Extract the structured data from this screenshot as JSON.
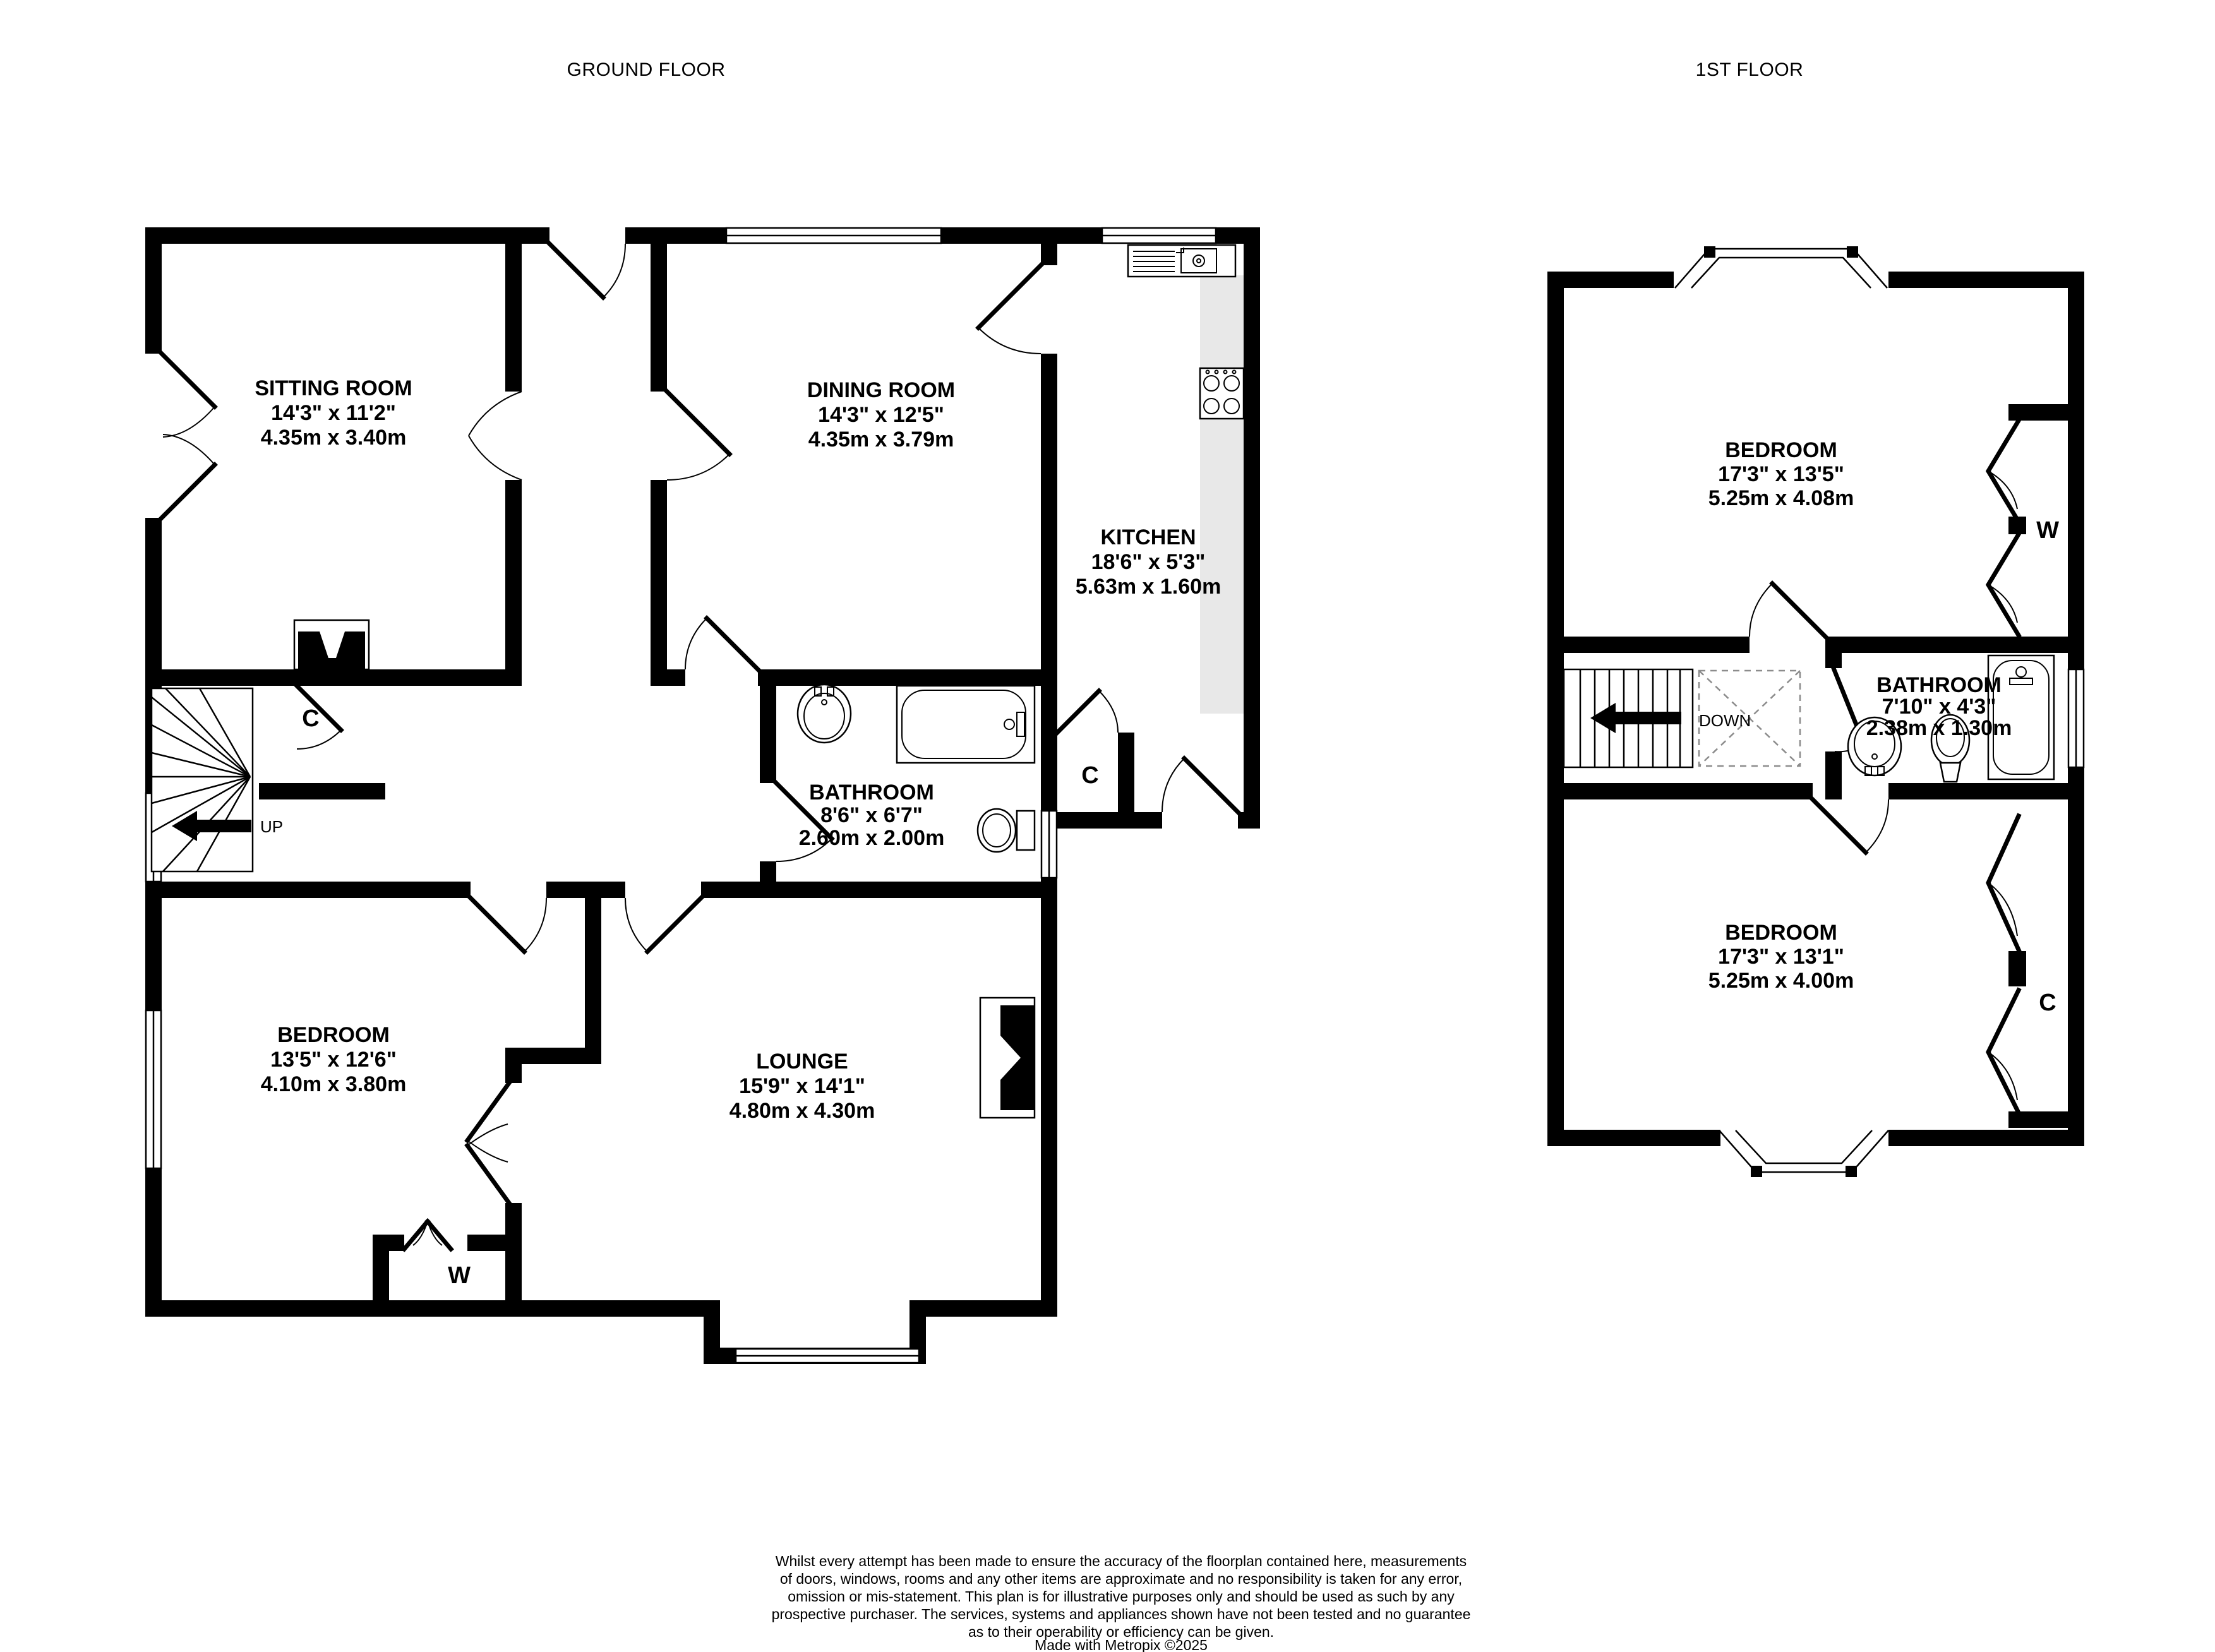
{
  "titles": {
    "ground": "GROUND FLOOR",
    "first": "1ST FLOOR"
  },
  "ground_floor": {
    "rooms": {
      "sitting_room": {
        "name": "SITTING ROOM",
        "imperial": "14'3\"  x 11'2\"",
        "metric": "4.35m  x 3.40m"
      },
      "dining_room": {
        "name": "DINING ROOM",
        "imperial": "14'3\"  x 12'5\"",
        "metric": "4.35m  x 3.79m"
      },
      "kitchen": {
        "name": "KITCHEN",
        "imperial": "18'6\"  x 5'3\"",
        "metric": "5.63m  x 1.60m"
      },
      "bathroom": {
        "name": "BATHROOM",
        "imperial": "8'6\"  x 6'7\"",
        "metric": "2.60m  x 2.00m"
      },
      "bedroom": {
        "name": "BEDROOM",
        "imperial": "13'5\"  x 12'6\"",
        "metric": "4.10m  x 3.80m"
      },
      "lounge": {
        "name": "LOUNGE",
        "imperial": "15'9\"  x 14'1\"",
        "metric": "4.80m  x 4.30m"
      }
    },
    "labels": {
      "stairs_up": "UP",
      "cupboard_hall": "C",
      "cupboard_kitchen": "C",
      "wardrobe": "W"
    }
  },
  "first_floor": {
    "rooms": {
      "bedroom_front": {
        "name": "BEDROOM",
        "imperial": "17'3\"  x 13'5\"",
        "metric": "5.25m  x 4.08m"
      },
      "bathroom": {
        "name": "BATHROOM",
        "imperial": "7'10\"  x 4'3\"",
        "metric": "2.38m  x 1.30m"
      },
      "bedroom_back": {
        "name": "BEDROOM",
        "imperial": "17'3\"  x 13'1\"",
        "metric": "5.25m  x 4.00m"
      }
    },
    "labels": {
      "stairs_down": "DOWN",
      "wardrobe": "W",
      "cupboard": "C"
    }
  },
  "footer": {
    "lines": [
      "Whilst every attempt has been made to ensure the accuracy of the floorplan contained here, measurements",
      "of doors, windows, rooms and any other items are approximate and no responsibility is taken for any error,",
      "omission or mis-statement. This plan is for illustrative purposes only and should be used as such by any",
      "prospective purchaser. The services, systems and appliances shown have not been tested and no guarantee",
      "as to their operability or efficiency can be given.",
      "Made with Metropix ©2025"
    ]
  }
}
